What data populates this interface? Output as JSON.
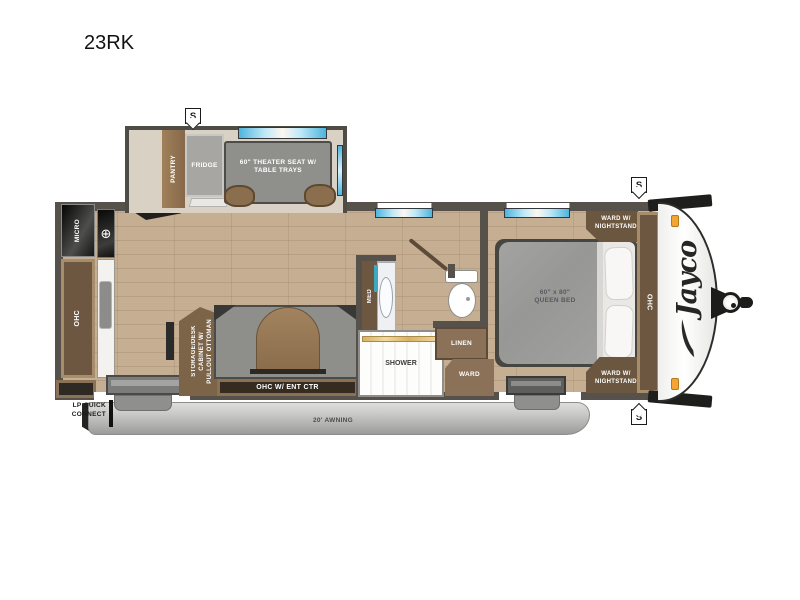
{
  "title": "23RK",
  "brand_logo": "Jayco",
  "stabilizer_marker": "S",
  "slideout": {
    "pantry": "PANTRY",
    "fridge": "FRIDGE",
    "theater_seat": "60\" THEATER SEAT W/\nTABLE TRAYS"
  },
  "kitchen": {
    "micro": "MICRO",
    "cooktop_icon": "⊕",
    "ohc": "OHC",
    "lp_quick_connect": "LP QUICK\nCONNECT"
  },
  "living": {
    "storage_desk": "STORAGE/DESK\nCABINET W/\nPULLOUT OTTOMAN",
    "ohc_ent_ctr": "OHC W/ ENT CTR"
  },
  "bathroom": {
    "med": "MED",
    "shower": "SHOWER",
    "linen": "LINEN",
    "ward": "WARD"
  },
  "bedroom": {
    "queen_bed": "60\" x 80\"\nQUEEN BED",
    "ward_nightstand_rear": "WARD W/\nNIGHTSTAND",
    "ward_nightstand_front": "WARD W/\nNIGHTSTAND",
    "ohc": "OHC"
  },
  "exterior": {
    "awning": "20' AWNING"
  },
  "colors": {
    "wall": "#56524b",
    "floor_wood": "#c6ae92",
    "cabinet_wood": "#6d5741",
    "cabinet_frame": "#a88d6c",
    "furniture_gray": "#8e8e8b",
    "window_blue": "#4fb4dd",
    "marker_light_orange": "#f2a435",
    "awning_gray": "#bcbcba",
    "accent_teal": "#3fa8c0"
  }
}
